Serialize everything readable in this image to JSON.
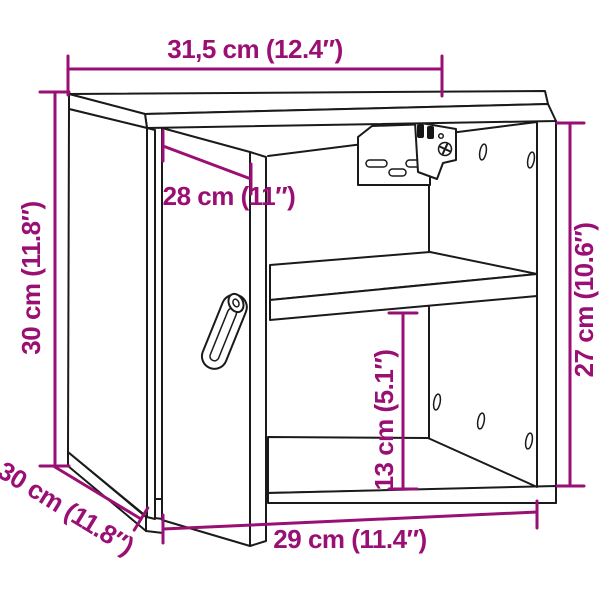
{
  "diagram": {
    "background": "#ffffff",
    "line_color": "#1a1a1a",
    "dimension_color": "#9a0f74",
    "subject": "wall cabinet with open door, interior shelf and wall-mount bracket",
    "dimensions": {
      "top_width": {
        "label": "31,5 cm (12.4″)",
        "cm": "31,5",
        "inch": "12.4"
      },
      "height_left": {
        "label": "30 cm (11.8″)",
        "cm": "30",
        "inch": "11.8"
      },
      "depth_left": {
        "label": "30 cm (11.8″)",
        "cm": "30",
        "inch": "11.8"
      },
      "door_width": {
        "label": "28 cm (11″)",
        "cm": "28",
        "inch": "11"
      },
      "interior_height_right": {
        "label": "27 cm (10.6″)",
        "cm": "27",
        "inch": "10.6"
      },
      "lower_compartment_height": {
        "label": "13 cm (5.1″)",
        "cm": "13",
        "inch": "5.1"
      },
      "bottom_width": {
        "label": "29 cm (11.4″)",
        "cm": "29",
        "inch": "11.4"
      }
    }
  }
}
